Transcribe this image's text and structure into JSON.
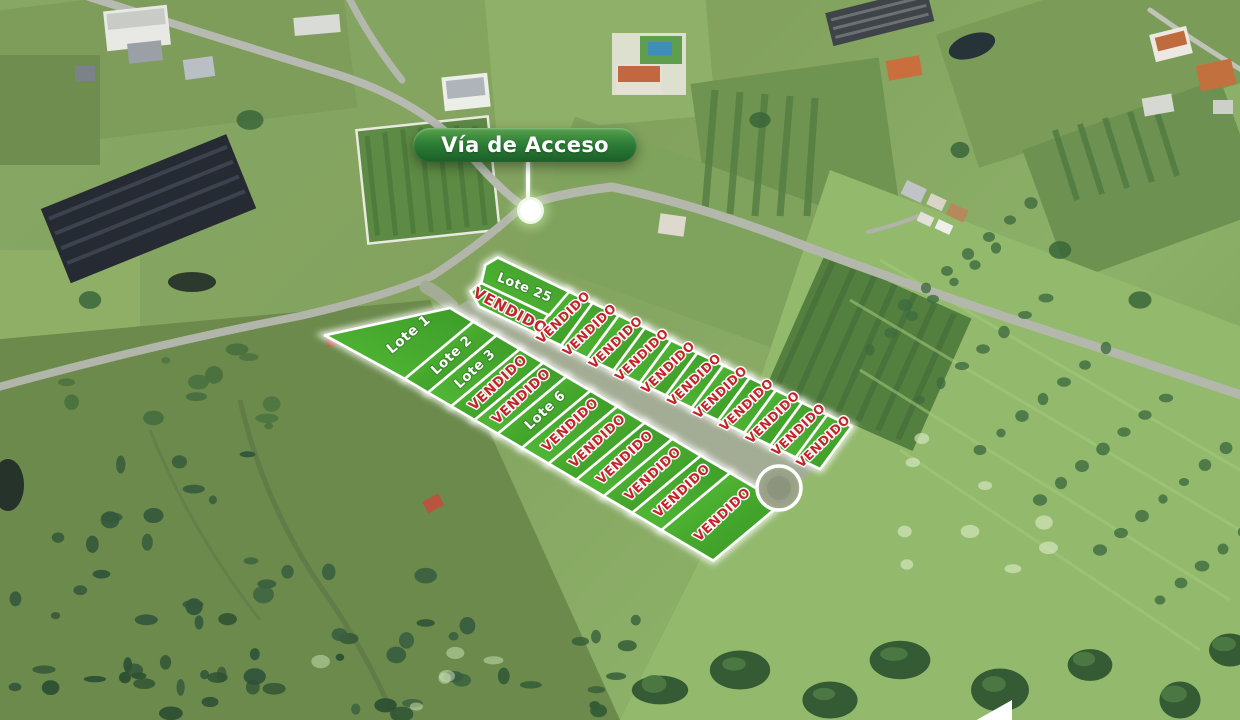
{
  "badge": {
    "label": "Vía de Acceso"
  },
  "map": {
    "sold_text_color": "#c3242a",
    "available_text_color": "#ffffff",
    "lot_fill_color": "#47a82e",
    "badge_color": "#2e7e38"
  },
  "lots": [
    {
      "id": 1,
      "band": "lower",
      "label": "Lote 1",
      "status": "available"
    },
    {
      "id": 2,
      "band": "lower",
      "label": "Lote 2",
      "status": "available"
    },
    {
      "id": 3,
      "band": "lower",
      "label": "Lote 3",
      "status": "available"
    },
    {
      "id": 4,
      "band": "lower",
      "label": "VENDIDO",
      "status": "sold"
    },
    {
      "id": 5,
      "band": "lower",
      "label": "VENDIDO",
      "status": "sold"
    },
    {
      "id": 6,
      "band": "lower",
      "label": "Lote 6",
      "status": "available"
    },
    {
      "id": 7,
      "band": "lower",
      "label": "VENDIDO",
      "status": "sold"
    },
    {
      "id": 8,
      "band": "lower",
      "label": "VENDIDO",
      "status": "sold"
    },
    {
      "id": 9,
      "band": "lower",
      "label": "VENDIDO",
      "status": "sold"
    },
    {
      "id": 10,
      "band": "lower",
      "label": "VENDIDO",
      "status": "sold"
    },
    {
      "id": 11,
      "band": "lower",
      "label": "VENDIDO",
      "status": "sold"
    },
    {
      "id": 12,
      "band": "lower",
      "label": "VENDIDO",
      "status": "sold"
    },
    {
      "id": 13,
      "band": "upper",
      "label": "VENDIDO",
      "status": "sold"
    },
    {
      "id": 14,
      "band": "upper",
      "label": "VENDIDO",
      "status": "sold"
    },
    {
      "id": 15,
      "band": "upper",
      "label": "VENDIDO",
      "status": "sold"
    },
    {
      "id": 16,
      "band": "upper",
      "label": "VENDIDO",
      "status": "sold"
    },
    {
      "id": 17,
      "band": "upper",
      "label": "VENDIDO",
      "status": "sold"
    },
    {
      "id": 18,
      "band": "upper",
      "label": "VENDIDO",
      "status": "sold"
    },
    {
      "id": 19,
      "band": "upper",
      "label": "VENDIDO",
      "status": "sold"
    },
    {
      "id": 20,
      "band": "upper",
      "label": "VENDIDO",
      "status": "sold"
    },
    {
      "id": 21,
      "band": "upper",
      "label": "VENDIDO",
      "status": "sold"
    },
    {
      "id": 22,
      "band": "upper",
      "label": "VENDIDO",
      "status": "sold"
    },
    {
      "id": 23,
      "band": "upper",
      "label": "VENDIDO",
      "status": "sold"
    },
    {
      "id": 24,
      "band": "upper",
      "label": "VENDIDO",
      "status": "sold"
    },
    {
      "id": 25,
      "band": "upper",
      "label": "Lote 25",
      "status": "available"
    }
  ]
}
